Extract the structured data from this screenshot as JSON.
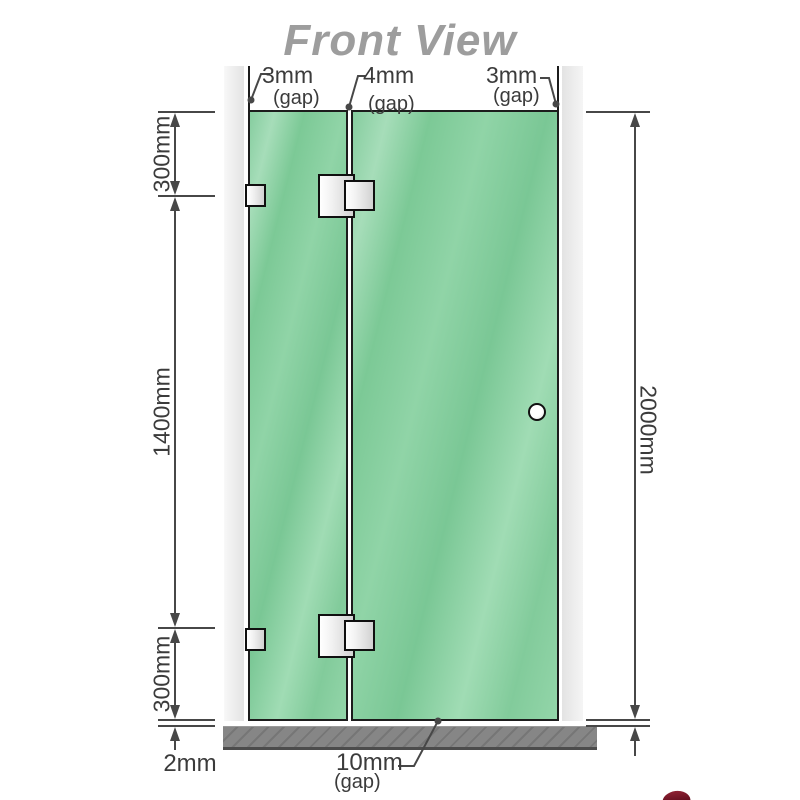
{
  "title": "Front View",
  "top_gap_annotations": [
    {
      "value": "3mm",
      "note": "(gap)"
    },
    {
      "value": "4mm",
      "note": "(gap)"
    },
    {
      "value": "3mm",
      "note": "(gap)"
    }
  ],
  "left_dimensions": [
    {
      "label": "300mm"
    },
    {
      "label": "1400mm"
    },
    {
      "label": "300mm"
    }
  ],
  "right_dimension": {
    "label": "2000mm"
  },
  "bottom_dimensions": {
    "floor_clearance": "2mm",
    "door_bottom_gap": "10mm",
    "door_bottom_gap_note": "(gap)"
  },
  "colors": {
    "glass_green": "#84cc9d",
    "glass_highlight": "#a6ddb9",
    "wall_gray": "#e8e8e8",
    "base_gray": "#868686",
    "outline_black": "#1c1c1c",
    "dimension_line": "#474747",
    "title_gray": "#9d9d9d",
    "text_dark": "#3b3b3b"
  }
}
